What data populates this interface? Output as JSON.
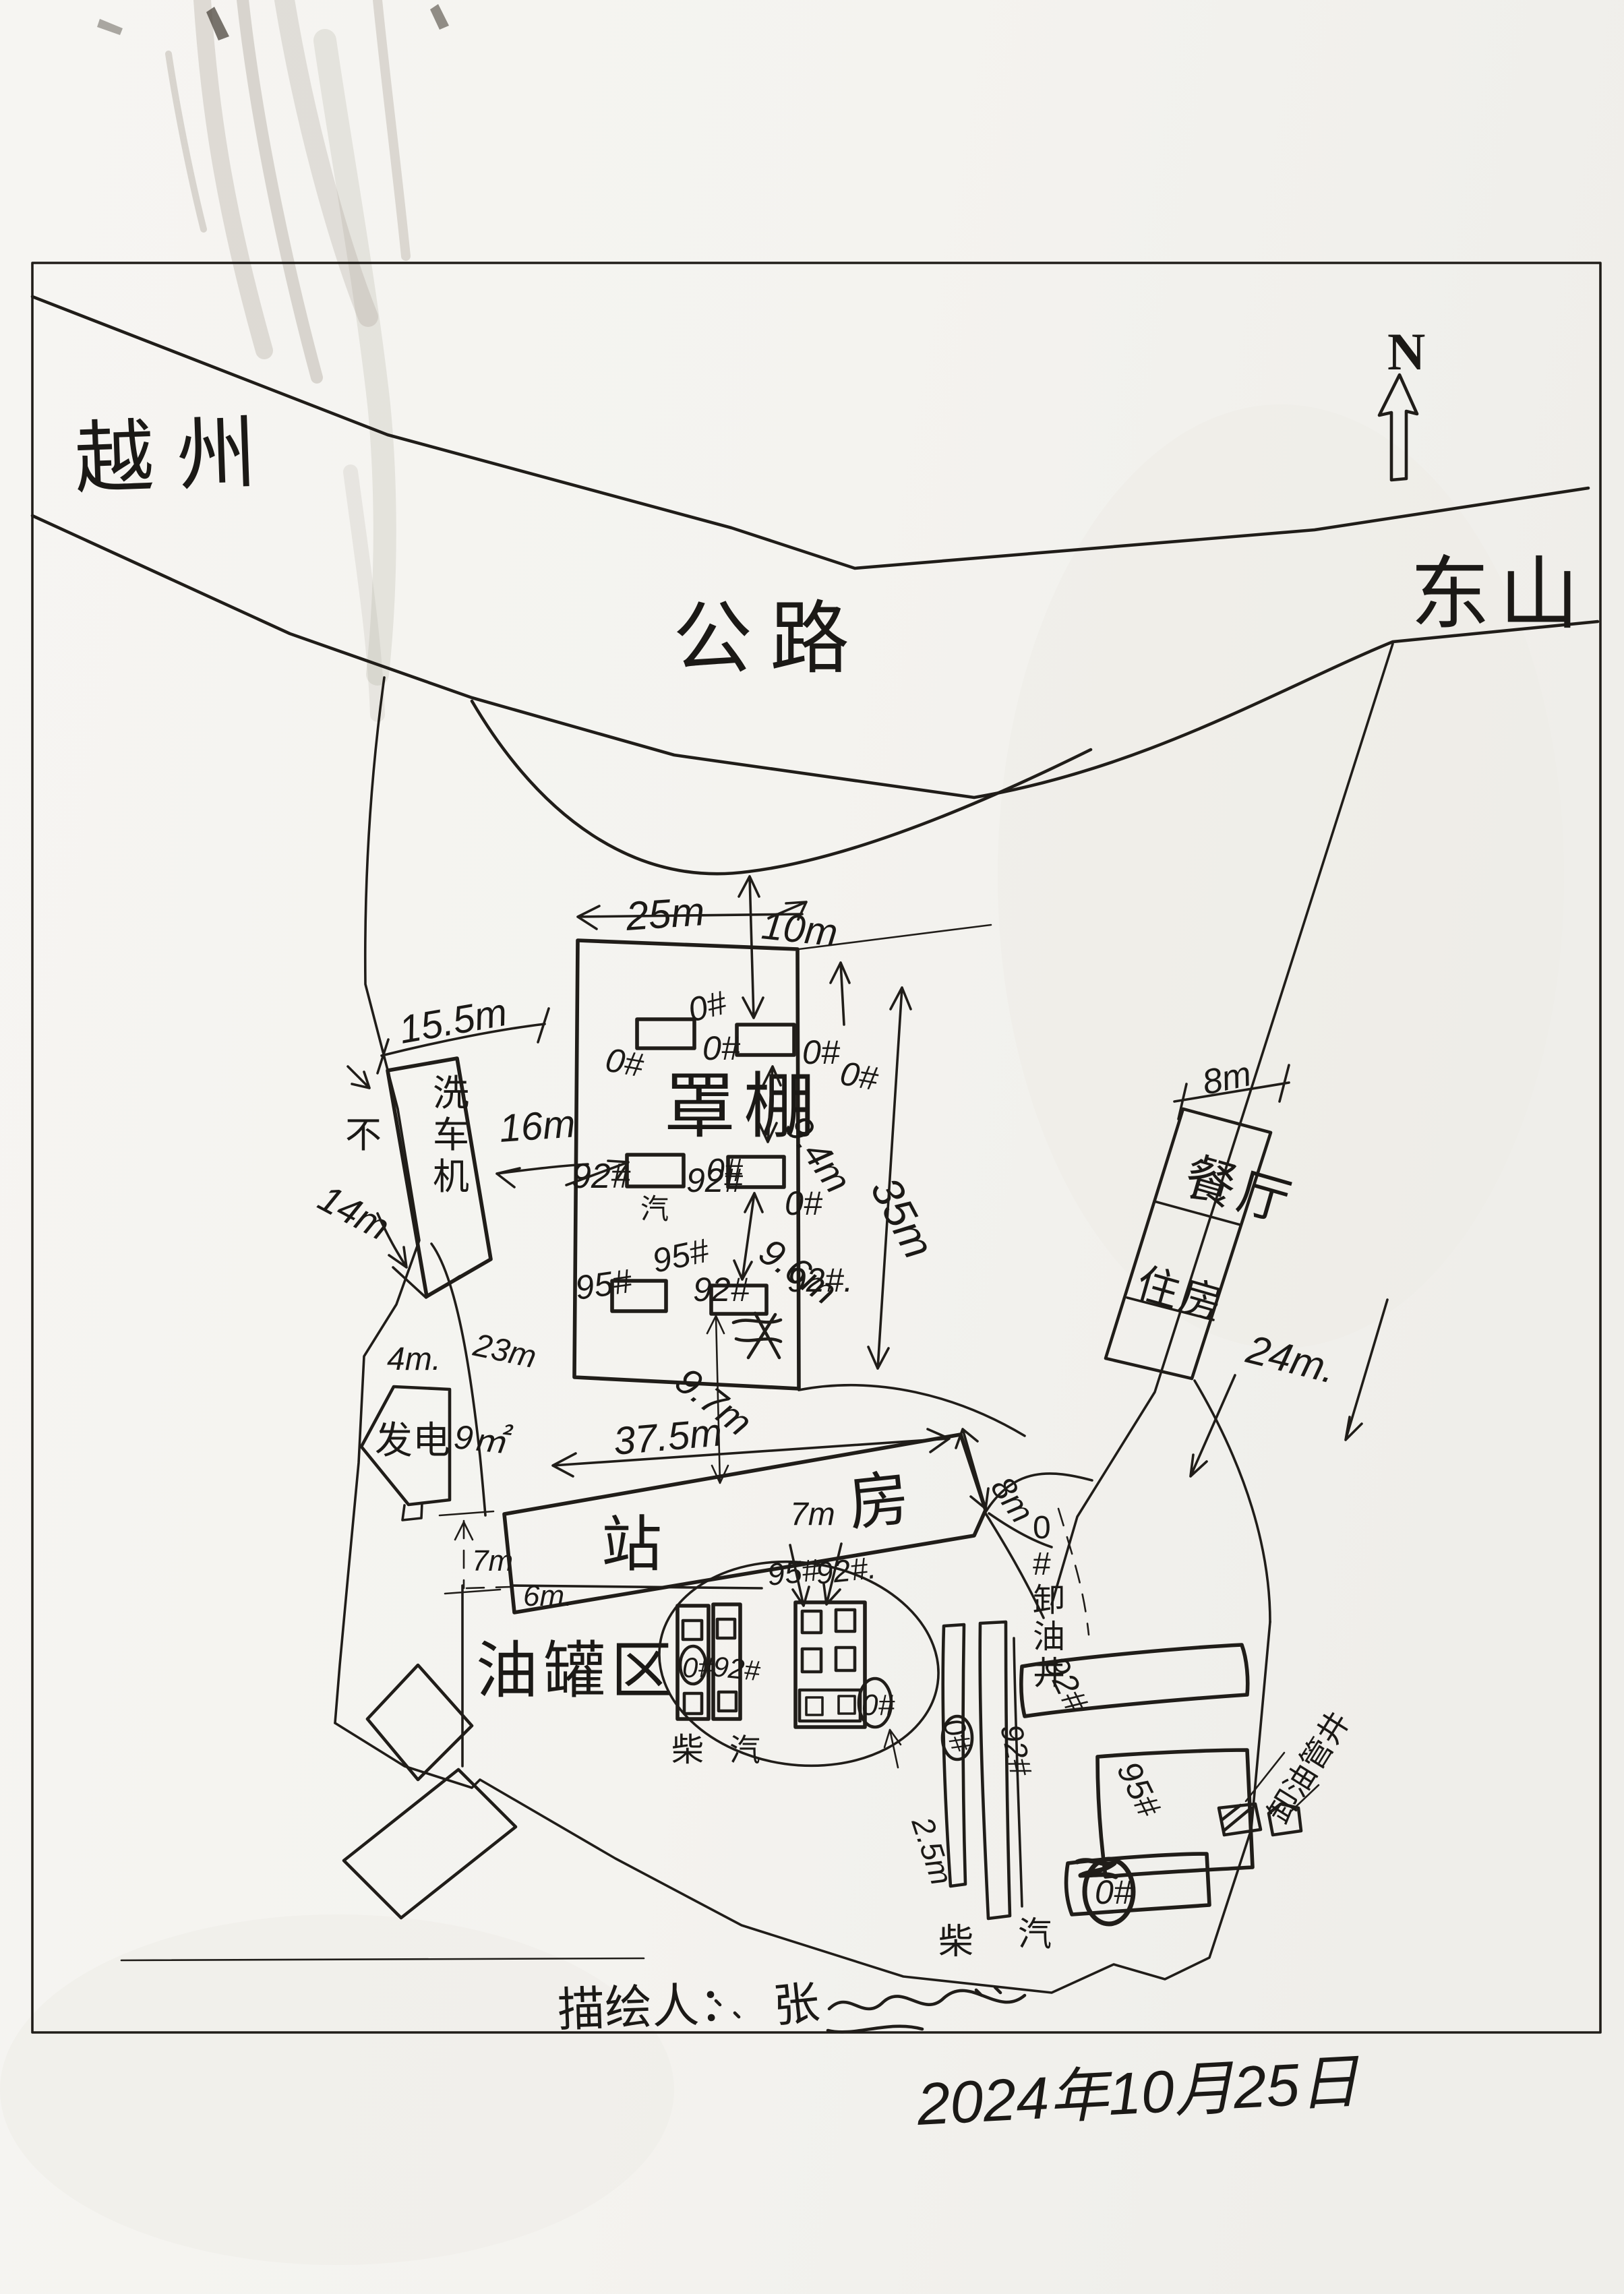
{
  "regions": {
    "yuezhou": "越州",
    "highway": "公路",
    "dongshan": "东山"
  },
  "compass": {
    "north": "N"
  },
  "canopy": {
    "label": "罩棚",
    "dim_width": "25m",
    "dim_gap_road": "10m",
    "dim_height": "35m",
    "dim_row_gap_1": "9.4m",
    "dim_row_gap_2": "9.6m",
    "dim_gap_station": "9.7m",
    "row1": [
      "0#",
      "0#",
      "0#",
      "0#",
      "0#"
    ],
    "row2": [
      "92#",
      "92#",
      "0#",
      "0#",
      "0#"
    ],
    "row2_sub": "汽",
    "row3": [
      "95#",
      "95#",
      "92#",
      "92#."
    ]
  },
  "carwash": {
    "label": "洗车机",
    "note": "不",
    "dim_length": "15.5m",
    "dim_side": "14m",
    "dim_gap_canopy": "16m"
  },
  "west_yard": {
    "dim_gap": "4m.",
    "dim_boundary": "23m",
    "dim_fence_gap": "7m",
    "generator_label": "发电",
    "generator_area": "9㎡"
  },
  "station_house": {
    "label_left": "站",
    "label_width": "7m",
    "label_right": "房",
    "dim_length": "37.5m",
    "dim_end_gap": "8m"
  },
  "canteen_building": {
    "dim_width": "8m",
    "label_top": "餐厅",
    "label_bottom": "住房",
    "dim_distance": "24m."
  },
  "tank_farm": {
    "label": "油罐区",
    "dim_gap": "6m.",
    "tank1_label": "0#",
    "tank2_label": "92#",
    "grid_label_1": "95#",
    "grid_label_2": "92#.",
    "grid_label_0": "0#",
    "fuel_diesel": "柴",
    "fuel_gasoline": "汽",
    "dim_clearance": "2.5m",
    "top_label_1": "95#",
    "top_label_2": "92#."
  },
  "unloading": {
    "vertical_label": "0#卸油井",
    "strip1_label": "0#",
    "strip2_label": "92#",
    "row1_label": "92#",
    "row2_label": "95#",
    "row3_label": "0#",
    "well_note": "卸油管井",
    "fuel_diesel": "柴",
    "fuel_gasoline": "汽"
  },
  "footer": {
    "drawer_label": "描绘人：",
    "drawer_name": "张",
    "date": "2024年10月25日"
  }
}
